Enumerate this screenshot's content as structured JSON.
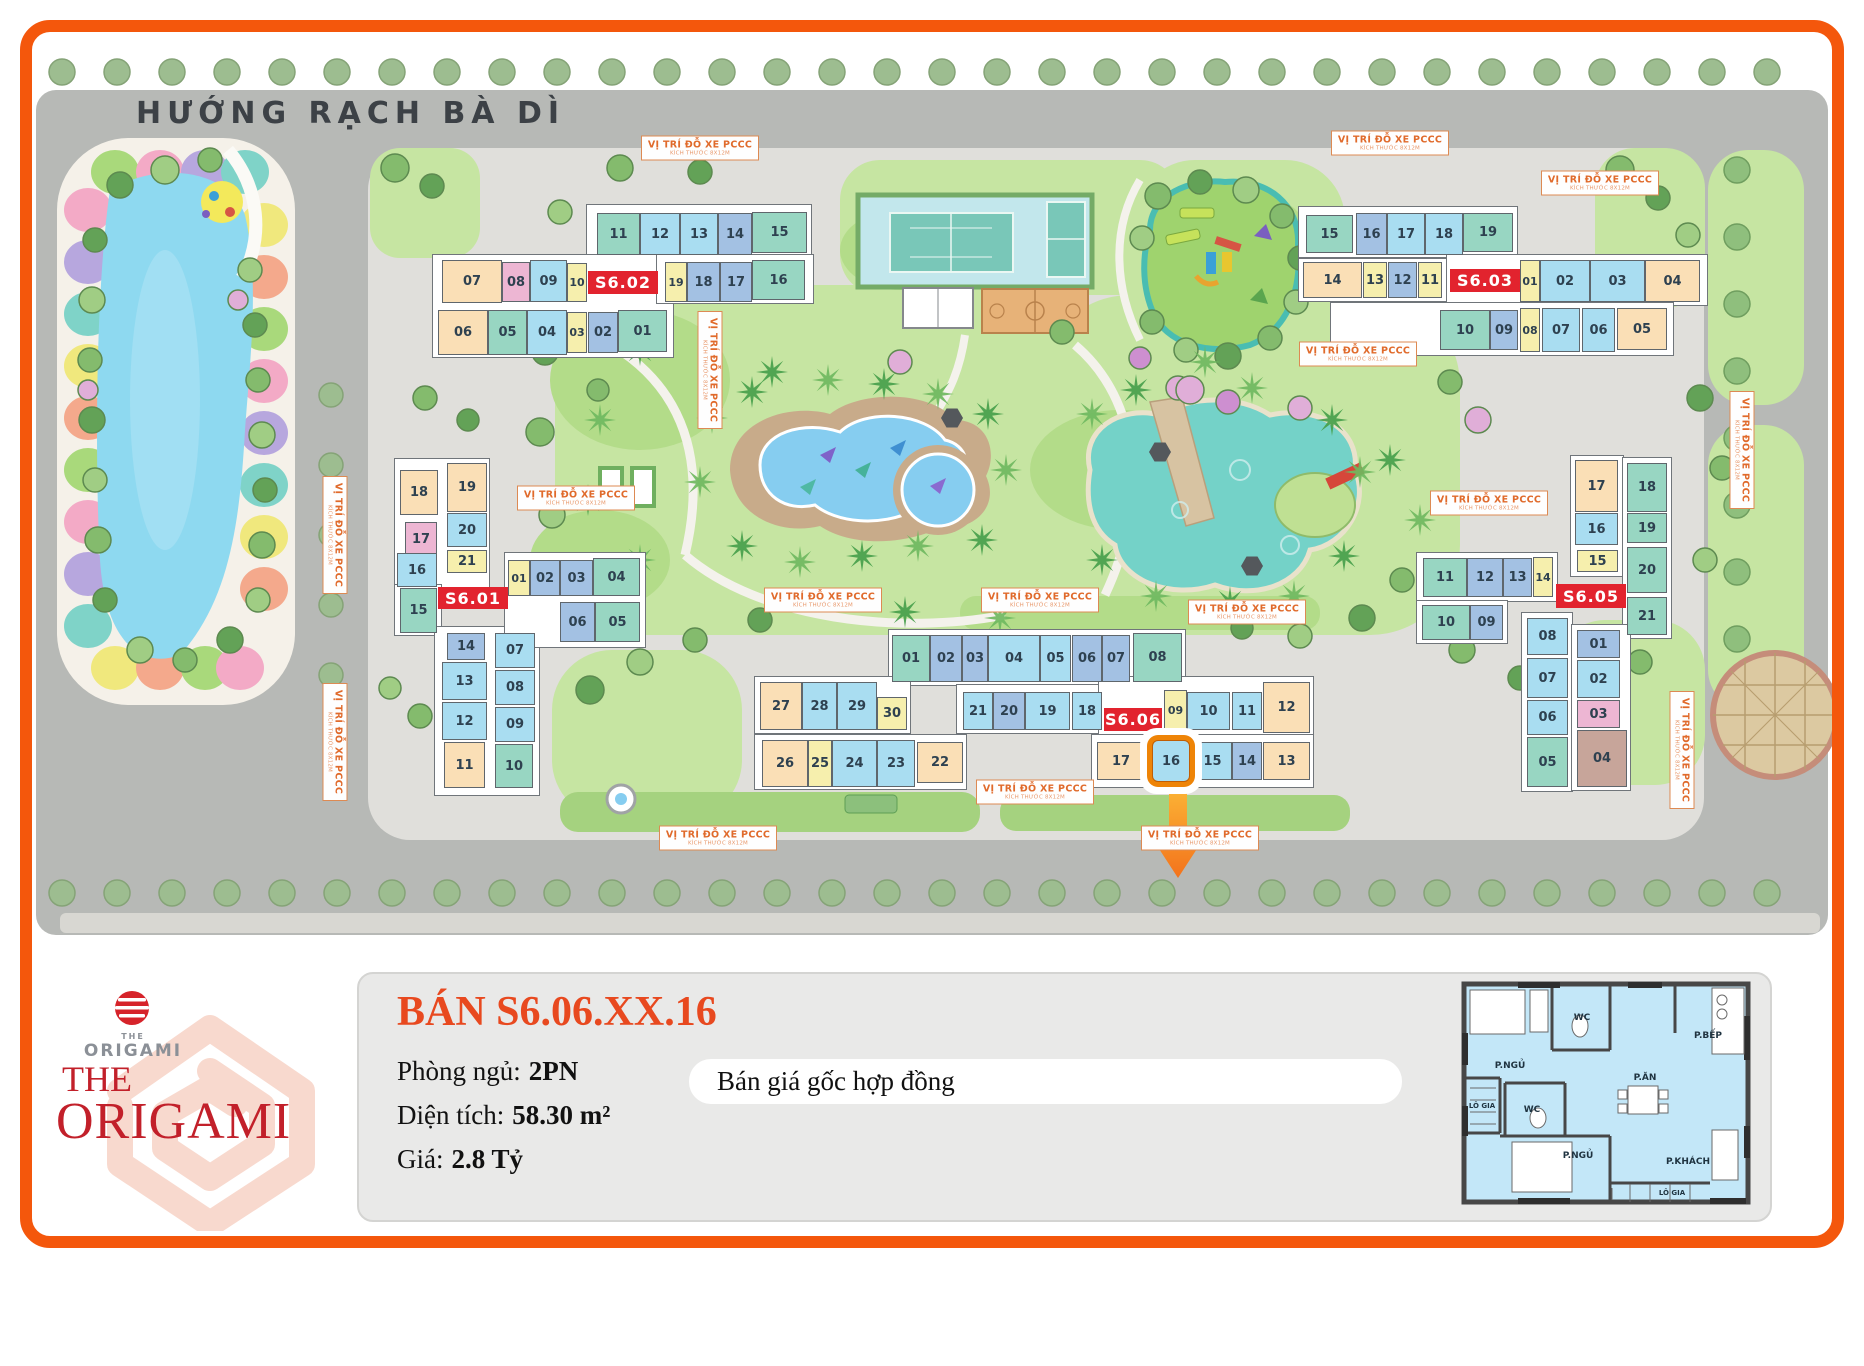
{
  "frame": {
    "color": "#f4570c"
  },
  "map": {
    "title": "HƯỚNG RẠCH BÀ DÌ",
    "building_label_color": "#e2232e",
    "highlight_unit": "16",
    "palette": {
      "teal": "#98d6c2",
      "lb": "#a9ddf1",
      "per": "#a3c1e3",
      "yellow": "#f6efad",
      "peach": "#fadfb6",
      "pink": "#edb6d3",
      "tan": "#c7a59a"
    },
    "parking_sign": {
      "line1": "VỊ TRÍ ĐỖ XE PCCC",
      "line2": "KÍCH THƯỚC 8X12M"
    },
    "parking_signs": [
      {
        "x": 700,
        "y": 148,
        "rot": 0
      },
      {
        "x": 1390,
        "y": 143,
        "rot": 0
      },
      {
        "x": 1600,
        "y": 183,
        "rot": 0
      },
      {
        "x": 1358,
        "y": 354,
        "rot": 0
      },
      {
        "x": 576,
        "y": 498,
        "rot": 0
      },
      {
        "x": 710,
        "y": 370,
        "rot": 90
      },
      {
        "x": 335,
        "y": 535,
        "rot": 90
      },
      {
        "x": 335,
        "y": 742,
        "rot": 90
      },
      {
        "x": 823,
        "y": 600,
        "rot": 0
      },
      {
        "x": 1040,
        "y": 600,
        "rot": 0
      },
      {
        "x": 1247,
        "y": 612,
        "rot": 0
      },
      {
        "x": 1489,
        "y": 503,
        "rot": 0
      },
      {
        "x": 1035,
        "y": 792,
        "rot": 0
      },
      {
        "x": 1200,
        "y": 838,
        "rot": 0
      },
      {
        "x": 718,
        "y": 838,
        "rot": 0
      },
      {
        "x": 1742,
        "y": 450,
        "rot": 90
      },
      {
        "x": 1682,
        "y": 750,
        "rot": 90
      }
    ],
    "buildings": [
      {
        "id": "S6.02",
        "label": {
          "x": 588,
          "y": 271,
          "w": 70,
          "h": 23
        },
        "slabs": [
          [
            586,
            204,
            226,
            53
          ],
          [
            432,
            254,
            242,
            104
          ],
          [
            656,
            254,
            158,
            50
          ]
        ],
        "cells": [
          [
            "11",
            597,
            213,
            43,
            42,
            "teal"
          ],
          [
            "12",
            640,
            213,
            40,
            42,
            "lb"
          ],
          [
            "13",
            680,
            213,
            38,
            42,
            "lb"
          ],
          [
            "14",
            718,
            213,
            34,
            42,
            "per"
          ],
          [
            "15",
            752,
            212,
            55,
            41,
            "teal"
          ],
          [
            "07",
            442,
            260,
            60,
            43,
            "peach"
          ],
          [
            "08",
            502,
            262,
            28,
            40,
            "pink"
          ],
          [
            "09",
            530,
            260,
            37,
            42,
            "lb"
          ],
          [
            "10",
            567,
            263,
            20,
            39,
            "yellow"
          ],
          [
            "19",
            665,
            262,
            22,
            40,
            "yellow"
          ],
          [
            "18",
            687,
            262,
            33,
            40,
            "per"
          ],
          [
            "17",
            720,
            262,
            32,
            40,
            "per"
          ],
          [
            "16",
            752,
            260,
            53,
            40,
            "teal"
          ],
          [
            "06",
            438,
            310,
            50,
            45,
            "peach"
          ],
          [
            "05",
            488,
            310,
            39,
            45,
            "teal"
          ],
          [
            "04",
            527,
            310,
            40,
            45,
            "lb"
          ],
          [
            "03",
            567,
            312,
            20,
            41,
            "yellow"
          ],
          [
            "02",
            588,
            312,
            30,
            41,
            "per"
          ],
          [
            "01",
            618,
            310,
            49,
            42,
            "teal"
          ]
        ]
      },
      {
        "id": "S6.03",
        "label": {
          "x": 1450,
          "y": 269,
          "w": 70,
          "h": 23
        },
        "slabs": [
          [
            1298,
            206,
            220,
            52
          ],
          [
            1298,
            258,
            150,
            44
          ],
          [
            1446,
            254,
            262,
            52
          ],
          [
            1330,
            302,
            344,
            54
          ]
        ],
        "cells": [
          [
            "15",
            1306,
            215,
            47,
            38,
            "teal"
          ],
          [
            "16",
            1356,
            213,
            31,
            42,
            "per"
          ],
          [
            "17",
            1387,
            213,
            38,
            42,
            "lb"
          ],
          [
            "18",
            1425,
            213,
            38,
            42,
            "lb"
          ],
          [
            "19",
            1463,
            213,
            50,
            39,
            "teal"
          ],
          [
            "14",
            1303,
            262,
            59,
            36,
            "peach"
          ],
          [
            "13",
            1363,
            262,
            24,
            36,
            "yellow"
          ],
          [
            "12",
            1388,
            262,
            29,
            36,
            "per"
          ],
          [
            "11",
            1418,
            262,
            24,
            36,
            "yellow"
          ],
          [
            "01",
            1520,
            260,
            20,
            42,
            "yellow"
          ],
          [
            "02",
            1540,
            260,
            50,
            42,
            "lb"
          ],
          [
            "03",
            1590,
            260,
            55,
            42,
            "lb"
          ],
          [
            "04",
            1645,
            260,
            55,
            42,
            "peach"
          ],
          [
            "10",
            1440,
            310,
            50,
            40,
            "teal"
          ],
          [
            "09",
            1490,
            310,
            28,
            40,
            "per"
          ],
          [
            "08",
            1520,
            308,
            20,
            44,
            "yellow"
          ],
          [
            "07",
            1542,
            308,
            38,
            44,
            "lb"
          ],
          [
            "06",
            1582,
            308,
            33,
            44,
            "lb"
          ],
          [
            "05",
            1617,
            308,
            50,
            42,
            "peach"
          ]
        ]
      },
      {
        "id": "S6.01",
        "label": {
          "x": 438,
          "y": 587,
          "w": 70,
          "h": 22
        },
        "slabs": [
          [
            394,
            458,
            96,
            132
          ],
          [
            394,
            584,
            48,
            52
          ],
          [
            434,
            626,
            106,
            170
          ],
          [
            504,
            552,
            142,
            96
          ]
        ],
        "cells": [
          [
            "18",
            400,
            470,
            38,
            45,
            "peach"
          ],
          [
            "19",
            447,
            463,
            40,
            49,
            "peach"
          ],
          [
            "17",
            405,
            522,
            32,
            35,
            "pink"
          ],
          [
            "20",
            447,
            513,
            40,
            34,
            "lb"
          ],
          [
            "16",
            397,
            553,
            40,
            34,
            "lb"
          ],
          [
            "21",
            447,
            550,
            40,
            23,
            "yellow"
          ],
          [
            "15",
            400,
            588,
            37,
            45,
            "teal"
          ],
          [
            "01",
            508,
            560,
            22,
            36,
            "yellow"
          ],
          [
            "02",
            530,
            560,
            30,
            36,
            "per"
          ],
          [
            "03",
            560,
            560,
            33,
            36,
            "per"
          ],
          [
            "04",
            593,
            558,
            47,
            38,
            "teal"
          ],
          [
            "06",
            560,
            602,
            35,
            40,
            "per"
          ],
          [
            "05",
            595,
            602,
            45,
            40,
            "teal"
          ],
          [
            "14",
            447,
            633,
            38,
            27,
            "per"
          ],
          [
            "07",
            495,
            633,
            40,
            35,
            "lb"
          ],
          [
            "13",
            442,
            662,
            45,
            38,
            "lb"
          ],
          [
            "08",
            495,
            670,
            40,
            35,
            "lb"
          ],
          [
            "12",
            442,
            702,
            45,
            38,
            "lb"
          ],
          [
            "09",
            495,
            707,
            40,
            35,
            "lb"
          ],
          [
            "11",
            444,
            742,
            41,
            46,
            "peach"
          ],
          [
            "10",
            495,
            744,
            38,
            44,
            "teal"
          ]
        ]
      },
      {
        "id": "S6.05",
        "label": {
          "x": 1556,
          "y": 584,
          "w": 70,
          "h": 24
        },
        "slabs": [
          [
            1570,
            455,
            54,
            122
          ],
          [
            1622,
            457,
            50,
            182
          ],
          [
            1416,
            552,
            142,
            50
          ],
          [
            1416,
            600,
            92,
            44
          ],
          [
            1521,
            612,
            52,
            180
          ],
          [
            1571,
            624,
            60,
            167
          ]
        ],
        "cells": [
          [
            "17",
            1575,
            460,
            43,
            52,
            "peach"
          ],
          [
            "18",
            1627,
            463,
            40,
            49,
            "teal"
          ],
          [
            "16",
            1575,
            513,
            43,
            32,
            "lb"
          ],
          [
            "19",
            1627,
            513,
            40,
            30,
            "teal"
          ],
          [
            "15",
            1577,
            550,
            41,
            22,
            "yellow"
          ],
          [
            "20",
            1627,
            547,
            40,
            46,
            "teal"
          ],
          [
            "21",
            1627,
            597,
            40,
            38,
            "teal"
          ],
          [
            "11",
            1423,
            558,
            44,
            39,
            "teal"
          ],
          [
            "12",
            1467,
            558,
            36,
            39,
            "per"
          ],
          [
            "13",
            1503,
            558,
            29,
            39,
            "per"
          ],
          [
            "14",
            1533,
            557,
            20,
            40,
            "yellow"
          ],
          [
            "10",
            1422,
            605,
            48,
            35,
            "teal"
          ],
          [
            "09",
            1470,
            605,
            33,
            35,
            "per"
          ],
          [
            "08",
            1527,
            618,
            41,
            37,
            "lb"
          ],
          [
            "07",
            1527,
            658,
            41,
            40,
            "lb"
          ],
          [
            "06",
            1527,
            700,
            41,
            35,
            "lb"
          ],
          [
            "05",
            1527,
            737,
            41,
            50,
            "teal"
          ],
          [
            "01",
            1577,
            630,
            43,
            28,
            "per"
          ],
          [
            "02",
            1577,
            660,
            43,
            38,
            "lb"
          ],
          [
            "03",
            1577,
            700,
            43,
            28,
            "pink"
          ],
          [
            "04",
            1577,
            730,
            50,
            57,
            "tan"
          ]
        ]
      },
      {
        "id": "S6.06",
        "label": {
          "x": 1104,
          "y": 708,
          "w": 58,
          "h": 23
        },
        "slabs": [
          [
            888,
            629,
            298,
            57
          ],
          [
            754,
            676,
            157,
            58
          ],
          [
            956,
            684,
            150,
            50
          ],
          [
            1098,
            676,
            216,
            60
          ],
          [
            754,
            734,
            213,
            56
          ],
          [
            1091,
            734,
            223,
            54
          ]
        ],
        "cells": [
          [
            "01",
            892,
            635,
            38,
            47,
            "teal"
          ],
          [
            "02",
            930,
            635,
            32,
            47,
            "per"
          ],
          [
            "03",
            962,
            635,
            26,
            47,
            "per"
          ],
          [
            "04",
            988,
            635,
            52,
            47,
            "lb"
          ],
          [
            "05",
            1040,
            635,
            31,
            47,
            "lb"
          ],
          [
            "06",
            1072,
            635,
            30,
            47,
            "per"
          ],
          [
            "07",
            1102,
            635,
            28,
            47,
            "per"
          ],
          [
            "08",
            1133,
            633,
            49,
            49,
            "teal"
          ],
          [
            "27",
            760,
            682,
            42,
            48,
            "peach"
          ],
          [
            "28",
            802,
            682,
            35,
            48,
            "lb"
          ],
          [
            "29",
            837,
            682,
            40,
            48,
            "lb"
          ],
          [
            "30",
            877,
            697,
            30,
            33,
            "yellow"
          ],
          [
            "21",
            963,
            692,
            30,
            38,
            "lb"
          ],
          [
            "20",
            993,
            692,
            32,
            38,
            "per"
          ],
          [
            "19",
            1025,
            692,
            45,
            38,
            "lb"
          ],
          [
            "18",
            1072,
            692,
            30,
            38,
            "lb"
          ],
          [
            "09",
            1164,
            690,
            23,
            40,
            "yellow"
          ],
          [
            "10",
            1187,
            692,
            43,
            38,
            "lb"
          ],
          [
            "11",
            1232,
            692,
            30,
            38,
            "lb"
          ],
          [
            "12",
            1263,
            682,
            47,
            51,
            "peach"
          ],
          [
            "26",
            762,
            740,
            46,
            47,
            "peach"
          ],
          [
            "25",
            808,
            740,
            24,
            47,
            "yellow"
          ],
          [
            "24",
            832,
            740,
            45,
            47,
            "lb"
          ],
          [
            "23",
            877,
            740,
            38,
            47,
            "lb"
          ],
          [
            "22",
            917,
            742,
            46,
            41,
            "peach"
          ],
          [
            "17",
            1097,
            742,
            48,
            38,
            "peach"
          ],
          [
            "16",
            1152,
            740,
            38,
            42,
            "lb",
            "hl"
          ],
          [
            "15",
            1193,
            742,
            39,
            38,
            "lb"
          ],
          [
            "14",
            1232,
            742,
            30,
            38,
            "per"
          ],
          [
            "13",
            1263,
            742,
            47,
            38,
            "peach"
          ]
        ]
      }
    ]
  },
  "panel": {
    "title": "BÁN S6.06.XX.16",
    "title_color": "#e8491f",
    "rows": [
      {
        "label": "Phòng ngủ:",
        "value": "2PN"
      },
      {
        "label": "Diện tích:",
        "value": "58.30 m²"
      },
      {
        "label": "Giá:",
        "value": "2.8 Tỷ"
      }
    ],
    "note": "Bán giá gốc hợp đồng"
  },
  "logo": {
    "small_the": "THE",
    "small_origami": "ORIGAMI",
    "big_the": "THE",
    "big_origami": "ORIGAMI"
  },
  "floorplan": {
    "labels": [
      "P.NGỦ",
      "WC",
      "P.BẾP",
      "LÔ GIA",
      "WC",
      "P.ĂN",
      "P.NGỦ",
      "P.KHÁCH",
      "LÔ GIA"
    ]
  }
}
